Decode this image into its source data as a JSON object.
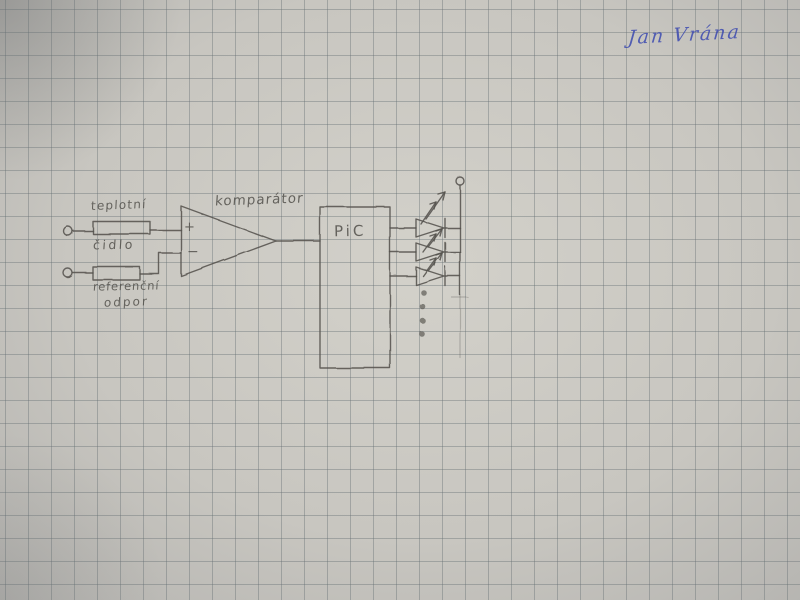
{
  "colors": {
    "paper-color": "#c9c7c1",
    "grid-color": "#878f91",
    "pencil-color": "#55534e",
    "ink-color": "#3c4ab0"
  },
  "signature": {
    "text": "Jan Vrána"
  },
  "schematic": {
    "blocks": {
      "temperature_sensor": {
        "label_top": "teplotní",
        "label_bottom": "čidlo"
      },
      "reference_resistor": {
        "label_top": "referenční",
        "label_bottom": "odpor"
      },
      "comparator": {
        "label": "komparátor",
        "plus_input": "+",
        "minus_input": "−"
      },
      "microcontroller": {
        "label": "PiC"
      },
      "led_column": {
        "led_count": 3,
        "more_indicator_dots": 4
      }
    }
  }
}
